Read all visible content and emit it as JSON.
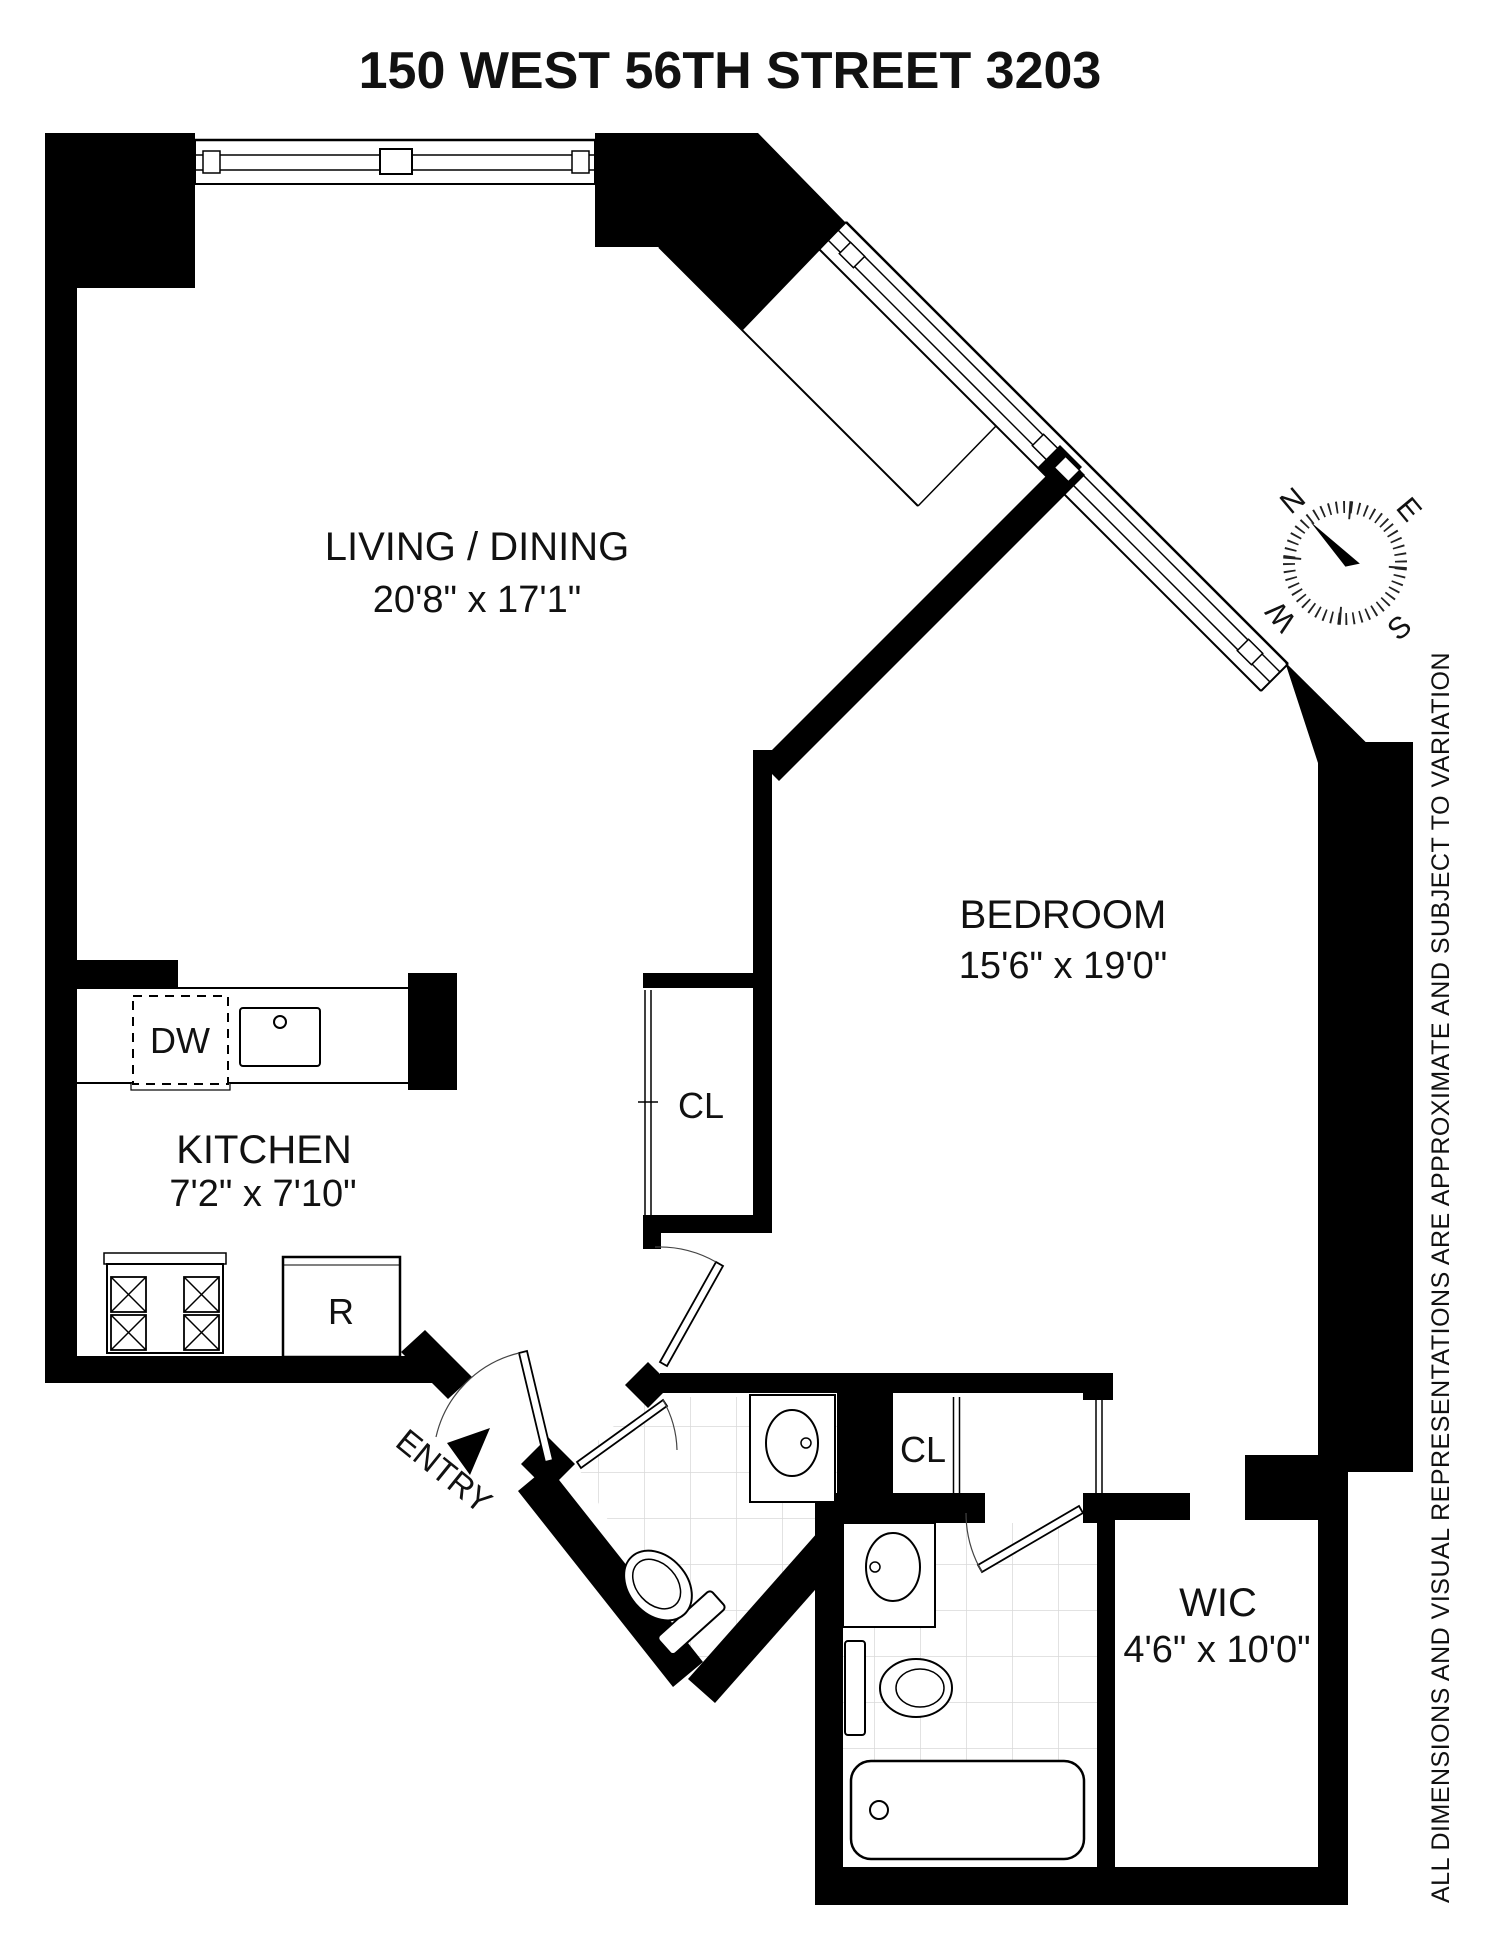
{
  "title": "150 WEST 56TH STREET 3203",
  "rooms": [
    {
      "name": "LIVING / DINING",
      "dims": "20'8\" x 17'1\""
    },
    {
      "name": "BEDROOM",
      "dims": "15'6\" x 19'0\""
    },
    {
      "name": "KITCHEN",
      "dims": "7'2\" x 7'10\""
    },
    {
      "name": "WIC",
      "dims": "4'6\" x 10'0\""
    }
  ],
  "labels": {
    "closet_hall": "CL",
    "closet_dressing": "CL",
    "dishwasher": "DW",
    "refrigerator": "R",
    "entry": "ENTRY"
  },
  "compass": {
    "north": "N",
    "east": "E",
    "south": "S",
    "west": "W"
  },
  "disclaimer": "ALL DIMENSIONS AND VISUAL REPRESENTATIONS ARE APPROXIMATE AND SUBJECT TO VARIATION",
  "colors": {
    "wall": "#000000",
    "text": "#111111",
    "tile_line": "#d9d9d9",
    "background": "#ffffff"
  }
}
